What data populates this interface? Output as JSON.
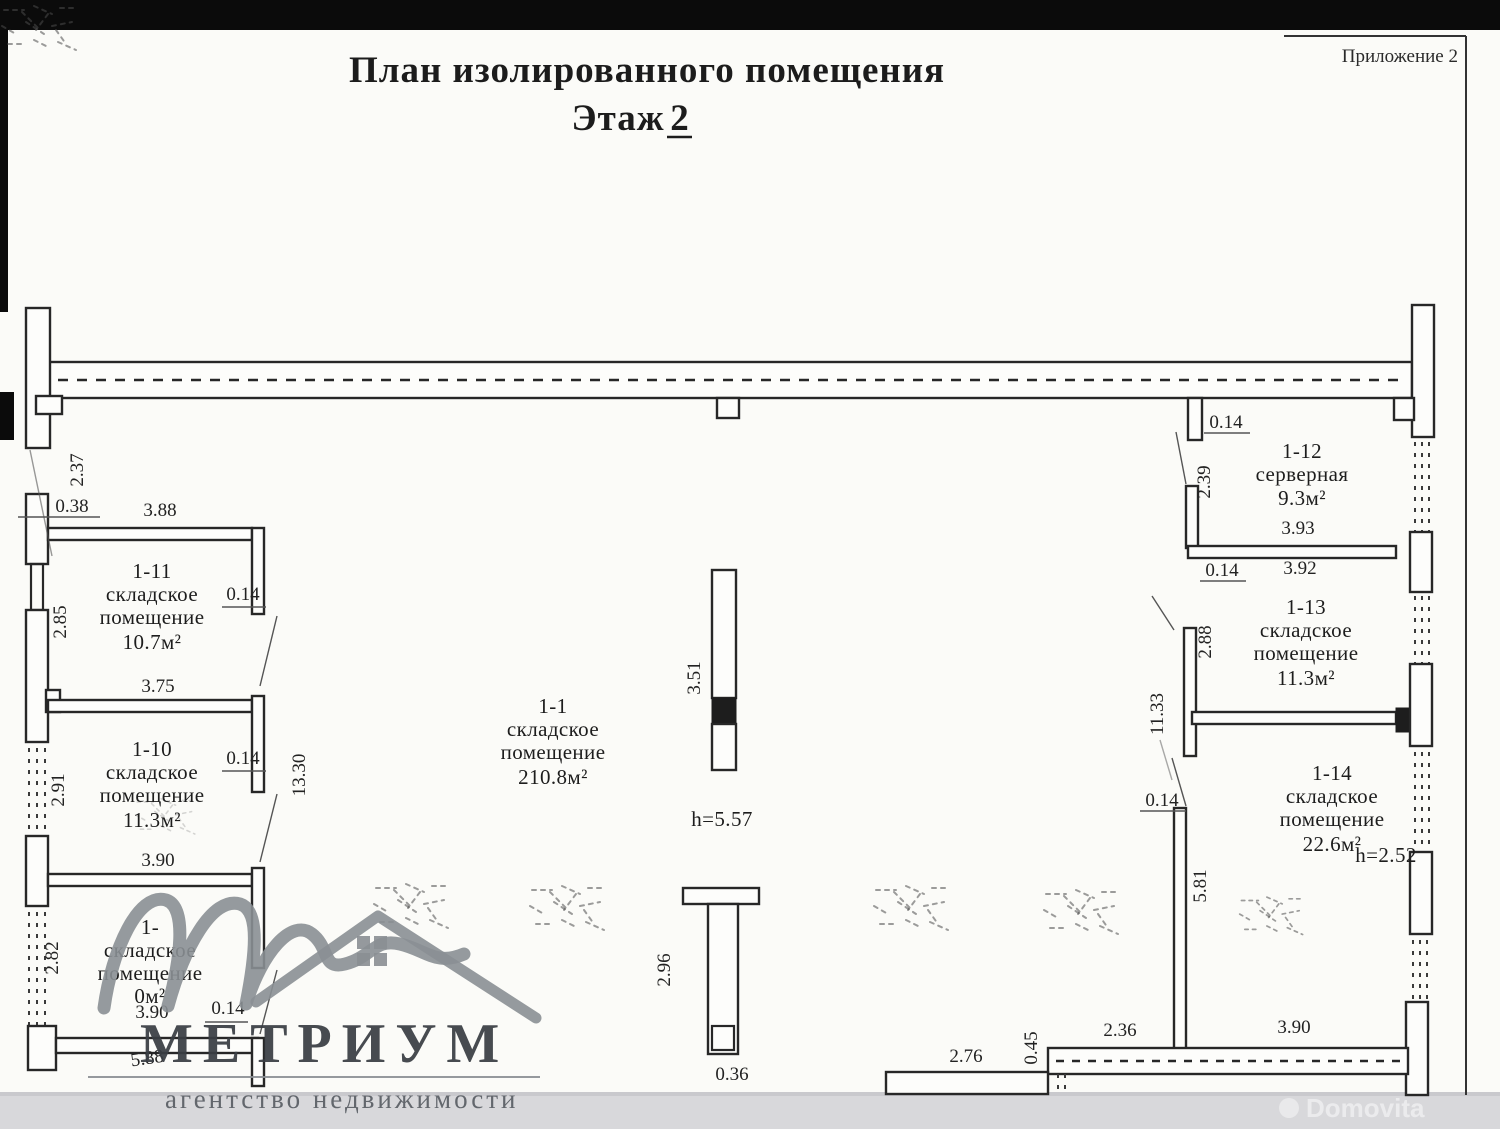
{
  "document": {
    "title": "План изолированного помещения",
    "floor_label": "Этаж",
    "floor_number": "2",
    "annex": "Приложение 2"
  },
  "rooms": {
    "r1": {
      "number": "1-1",
      "name_line1": "складское",
      "name_line2": "помещение",
      "area": "210.8м²",
      "ceiling_height": "h=5.57"
    },
    "r9": {
      "number": "1-",
      "name_line1": "складское",
      "name_line2": "помещение",
      "area": "0м²"
    },
    "r10": {
      "number": "1-10",
      "name_line1": "складское",
      "name_line2": "помещение",
      "area": "11.3м²"
    },
    "r11": {
      "number": "1-11",
      "name_line1": "складское",
      "name_line2": "помещение",
      "area": "10.7м²"
    },
    "r12": {
      "number": "1-12",
      "name_line1": "серверная",
      "area": "9.3м²"
    },
    "r13": {
      "number": "1-13",
      "name_line1": "складское",
      "name_line2": "помещение",
      "area": "11.3м²"
    },
    "r14": {
      "number": "1-14",
      "name_line1": "складское",
      "name_line2": "помещение",
      "area": "22.6м²",
      "ceiling_height": "h=2.52"
    }
  },
  "dimensions": {
    "top_left_vertical": "2.37",
    "left_offset": "0.38",
    "r11_width": "3.88",
    "r11_depth": "2.85",
    "r11_wall": "0.14",
    "r11_bottom_width": "3.75",
    "r10_depth": "2.91",
    "r10_wall": "0.14",
    "hall_left_length": "13.30",
    "r10_bottom_width": "3.90",
    "r9_depth": "2.82",
    "r9_bottom_width": "3.90",
    "r9_wall": "0.14",
    "bottom_left_width": "5.88",
    "column_top": "3.51",
    "column_bottom_height": "2.96",
    "column_bottom_width": "0.36",
    "bottom_center_width": "2.76",
    "bottom_step": "0.45",
    "bottom_right_width1": "2.36",
    "bottom_right_width2": "3.90",
    "r12_wall_top": "0.14",
    "r12_depth": "2.39",
    "r12_width": "3.93",
    "r12_wall_bottom": "0.14",
    "r13_top_width": "3.92",
    "r13_depth": "2.88",
    "hall_right_length": "11.33",
    "r14_wall": "0.14",
    "r14_depth": "5.81"
  },
  "watermark": {
    "brand": "МЕТРИУМ",
    "tagline": "агентство недвижимости",
    "portal_ghost": "Domovita",
    "icons": {
      "logo_squiggle": "cursive-m-icon",
      "roof": "house-roof-icon"
    }
  },
  "colors": {
    "paper": "#fbfbf8",
    "ink": "#272727",
    "watermark_gray": "#8a8f94",
    "scan_bar": "#0b0b0b",
    "footer_bar": "#d8d8db"
  }
}
